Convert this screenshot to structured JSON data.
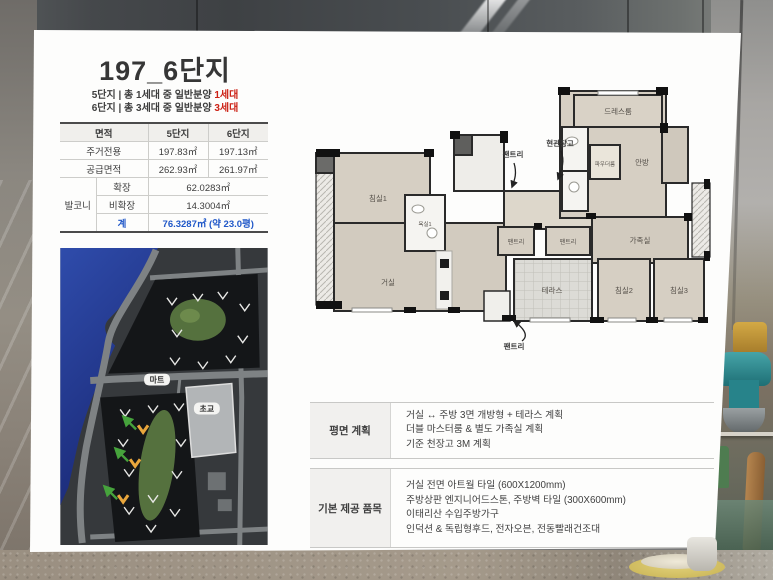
{
  "slide": {
    "title": "197_6단지",
    "subtitle_lines": [
      {
        "text": "5단지 | 총 1세대 중 일반분양 ",
        "highlight": "1세대"
      },
      {
        "text": "6단지 | 총 3세대 중 일반분양 ",
        "highlight": "3세대"
      }
    ],
    "area_table": {
      "col_area": "면적",
      "col_5": "5단지",
      "col_6": "6단지",
      "rows": [
        {
          "label": "주거전용",
          "v5": "197.83㎡",
          "v6": "197.13㎡"
        },
        {
          "label": "공급면적",
          "v5": "262.93㎡",
          "v6": "261.97㎡"
        }
      ],
      "balcony_label": "발코니",
      "balcony_rows": [
        {
          "label": "확장",
          "value": "62.0283㎡"
        },
        {
          "label": "비확장",
          "value": "14.3004㎡"
        },
        {
          "label": "계",
          "value": "76.3287㎡ (약 23.0평)"
        }
      ]
    },
    "map_labels": {
      "mart": "마트",
      "school": "초교"
    },
    "floorplan_labels": {
      "bedroom1": "침실1",
      "bath1": "욕실1",
      "living": "거실",
      "dressroom": "드레스룸",
      "master": "안방",
      "powder": "파우더룸",
      "family": "가족실",
      "pantry_a": "팬트리",
      "pantry_b": "팬트리",
      "terrace": "테라스",
      "bedroom2": "침실2",
      "bedroom3": "침실3",
      "callout_pantry_top": "팬트리",
      "callout_entry_storage": "현관창고",
      "callout_pantry_bottom": "팬트리"
    },
    "info_rows": [
      {
        "label": "평면 계획",
        "lines": [
          "거실 ↔ 주방 3면 개방형 + 테라스 계획",
          "더블 마스터룸 & 별도 가족실 계획",
          "기준 천장고 3M 계획"
        ]
      },
      {
        "label": "기본 제공 품목",
        "lines": [
          "거실 전면 아트월 타일 (600X1200mm)",
          "주방상판 엔지니어드스톤, 주방벽 타일 (300X600mm)",
          "이태리산 수입주방가구",
          "인덕션 & 독립형후드, 전자오븐, 전동빨래건조대"
        ]
      }
    ],
    "colors": {
      "accent_red": "#cc2014",
      "accent_blue": "#1f57c8",
      "plan_wall": "#1d1d1d",
      "map_water": "#2b46a6",
      "map_highlight_orange": "#e9a63c",
      "map_arrow_green": "#46a33c"
    }
  }
}
